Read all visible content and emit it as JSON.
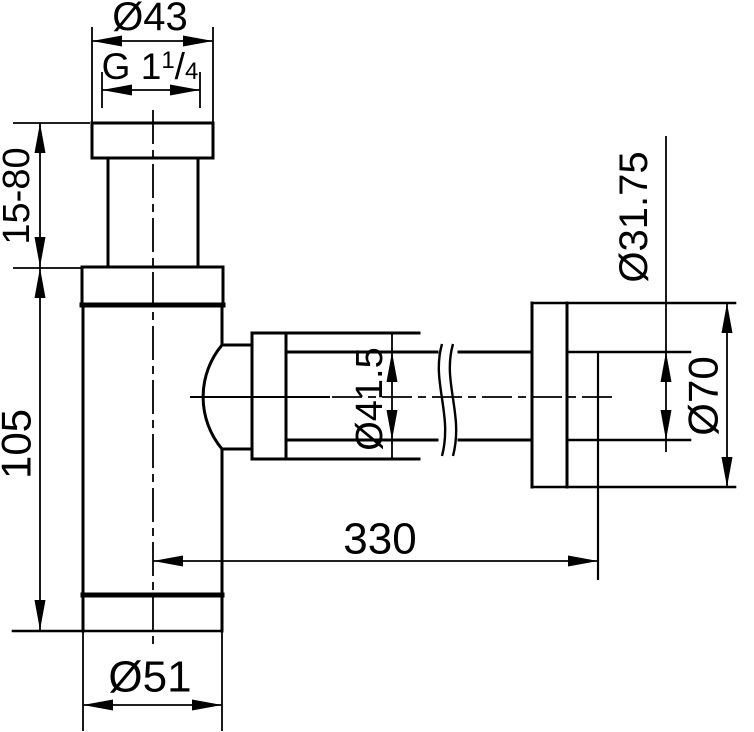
{
  "page": {
    "background": "#ffffff",
    "ink_color": "#000000"
  },
  "drawing": {
    "description": "bottle-trap siphon technical dimension drawing",
    "canvas": {
      "width": 754,
      "height": 732
    },
    "labels": [
      {
        "name": "dim-label-top-flange-diameter",
        "text": "Ø43",
        "x": 150,
        "y": 17,
        "rotate": 0,
        "size": 40
      },
      {
        "name": "dim-label-thread-size",
        "text": "G 1¼",
        "x": 150,
        "y": 66,
        "rotate": 0,
        "size": 37,
        "parts": [
          {
            "t": "G 1",
            "size": 37,
            "dy": 0
          },
          {
            "t": "1",
            "size": 24,
            "dy": -11
          },
          {
            "t": "/",
            "size": 37,
            "dy": 11
          },
          {
            "t": "4",
            "size": 24,
            "dy": 0
          }
        ]
      },
      {
        "name": "dim-label-adjustable-height",
        "text": "15-80",
        "x": 17,
        "y": 196,
        "rotate": -90,
        "size": 38
      },
      {
        "name": "dim-label-body-height",
        "text": "105",
        "x": 16,
        "y": 444,
        "rotate": -90,
        "size": 42
      },
      {
        "name": "dim-label-body-diameter",
        "text": "Ø51",
        "x": 150,
        "y": 677,
        "rotate": 0,
        "size": 44
      },
      {
        "name": "dim-label-sleeve-diameter",
        "text": "Ø41.5",
        "x": 370,
        "y": 399,
        "rotate": -90,
        "size": 38
      },
      {
        "name": "dim-label-wall-distance",
        "text": "330",
        "x": 380,
        "y": 539,
        "rotate": 0,
        "size": 44
      },
      {
        "name": "dim-label-wall-pipe-diameter",
        "text": "Ø31.75",
        "x": 634,
        "y": 217,
        "rotate": -90,
        "size": 40
      },
      {
        "name": "dim-label-wall-flange-diameter",
        "text": "Ø70",
        "x": 703,
        "y": 396,
        "rotate": -90,
        "size": 42
      }
    ],
    "lines": [
      {
        "name": "flange-top",
        "x1": 92,
        "y1": 123,
        "x2": 213,
        "y2": 123,
        "w": 3
      },
      {
        "name": "flange-bottom",
        "x1": 92,
        "y1": 158,
        "x2": 213,
        "y2": 158,
        "w": 3
      },
      {
        "name": "flange-left",
        "x1": 92,
        "y1": 123,
        "x2": 92,
        "y2": 158,
        "w": 3
      },
      {
        "name": "flange-right",
        "x1": 213,
        "y1": 123,
        "x2": 213,
        "y2": 158,
        "w": 3
      },
      {
        "name": "riser-tube-left",
        "x1": 108,
        "y1": 158,
        "x2": 108,
        "y2": 267,
        "w": 3
      },
      {
        "name": "riser-tube-right",
        "x1": 198,
        "y1": 158,
        "x2": 198,
        "y2": 267,
        "w": 3
      },
      {
        "name": "collar-top",
        "x1": 82,
        "y1": 267,
        "x2": 223,
        "y2": 267,
        "w": 3
      },
      {
        "name": "collar-left",
        "x1": 82,
        "y1": 267,
        "x2": 82,
        "y2": 304,
        "w": 3
      },
      {
        "name": "collar-right",
        "x1": 223,
        "y1": 267,
        "x2": 223,
        "y2": 304,
        "w": 3
      },
      {
        "name": "collar-body-joint",
        "x1": 82,
        "y1": 305,
        "x2": 223,
        "y2": 305,
        "w": 5
      },
      {
        "name": "body-left",
        "x1": 83,
        "y1": 305,
        "x2": 83,
        "y2": 631,
        "w": 3
      },
      {
        "name": "body-right-upper",
        "x1": 222,
        "y1": 305,
        "x2": 222,
        "y2": 345,
        "w": 3
      },
      {
        "name": "body-right-lower",
        "x1": 222,
        "y1": 449,
        "x2": 222,
        "y2": 595,
        "w": 3
      },
      {
        "name": "body-cap-joint",
        "x1": 83,
        "y1": 595,
        "x2": 222,
        "y2": 595,
        "w": 5
      },
      {
        "name": "cap-right",
        "x1": 222,
        "y1": 595,
        "x2": 222,
        "y2": 631,
        "w": 3
      },
      {
        "name": "cap-bottom-and-105-ext",
        "x1": 13,
        "y1": 631,
        "x2": 222,
        "y2": 631,
        "w": 2.6
      },
      {
        "name": "boss-stub-top",
        "x1": 222,
        "y1": 345,
        "x2": 252,
        "y2": 345,
        "w": 3
      },
      {
        "name": "boss-stub-bottom",
        "x1": 222,
        "y1": 449,
        "x2": 252,
        "y2": 449,
        "w": 3
      },
      {
        "name": "nut-left",
        "x1": 252,
        "y1": 333,
        "x2": 252,
        "y2": 459,
        "w": 3
      },
      {
        "name": "nut-right",
        "x1": 286,
        "y1": 333,
        "x2": 286,
        "y2": 459,
        "w": 3
      },
      {
        "name": "sleeve-top",
        "x1": 252,
        "y1": 333,
        "x2": 419,
        "y2": 333,
        "w": 3
      },
      {
        "name": "sleeve-bottom",
        "x1": 252,
        "y1": 459,
        "x2": 419,
        "y2": 459,
        "w": 3
      },
      {
        "name": "pipe-top-left",
        "x1": 286,
        "y1": 352,
        "x2": 437,
        "y2": 352,
        "w": 3
      },
      {
        "name": "pipe-bottom-left",
        "x1": 286,
        "y1": 440,
        "x2": 437,
        "y2": 440,
        "w": 3
      },
      {
        "name": "pipe-top-right",
        "x1": 459,
        "y1": 352,
        "x2": 532,
        "y2": 352,
        "w": 3
      },
      {
        "name": "pipe-bottom-right",
        "x1": 459,
        "y1": 440,
        "x2": 532,
        "y2": 440,
        "w": 3
      },
      {
        "name": "wall-flange-left",
        "x1": 532,
        "y1": 303,
        "x2": 532,
        "y2": 487,
        "w": 3
      },
      {
        "name": "wall-flange-right",
        "x1": 567,
        "y1": 303,
        "x2": 567,
        "y2": 487,
        "w": 3
      },
      {
        "name": "wall-flange-top-and-d70-ext",
        "x1": 532,
        "y1": 303,
        "x2": 735,
        "y2": 303,
        "w": 2.6
      },
      {
        "name": "wall-flange-bottom-and-d70-ext",
        "x1": 532,
        "y1": 487,
        "x2": 735,
        "y2": 487,
        "w": 2.6
      },
      {
        "name": "wall-pipe-top-and-ext",
        "x1": 567,
        "y1": 352,
        "x2": 690,
        "y2": 352,
        "w": 2.6
      },
      {
        "name": "wall-pipe-bottom-and-ext",
        "x1": 567,
        "y1": 440,
        "x2": 690,
        "y2": 440,
        "w": 2.6
      },
      {
        "name": "pipe-end-and-330-ext",
        "x1": 598,
        "y1": 352,
        "x2": 598,
        "y2": 580,
        "w": 2.2
      },
      {
        "name": "ext-d43-left",
        "x1": 92,
        "y1": 27,
        "x2": 92,
        "y2": 125,
        "w": 1.8
      },
      {
        "name": "ext-d43-right",
        "x1": 213,
        "y1": 27,
        "x2": 213,
        "y2": 125,
        "w": 1.8
      },
      {
        "name": "dim-d43",
        "x1": 92,
        "y1": 41,
        "x2": 213,
        "y2": 41,
        "w": 1.8
      },
      {
        "name": "ext-thread-left",
        "x1": 102,
        "y1": 72,
        "x2": 102,
        "y2": 108,
        "w": 1.8
      },
      {
        "name": "ext-thread-right",
        "x1": 200,
        "y1": 72,
        "x2": 200,
        "y2": 108,
        "w": 1.8
      },
      {
        "name": "dim-thread",
        "x1": 102,
        "y1": 90,
        "x2": 200,
        "y2": 90,
        "w": 1.8
      },
      {
        "name": "ext-1580-top",
        "x1": 13,
        "y1": 123,
        "x2": 90,
        "y2": 123,
        "w": 1.8
      },
      {
        "name": "ext-shared-collar-top",
        "x1": 13,
        "y1": 268,
        "x2": 81,
        "y2": 268,
        "w": 1.8
      },
      {
        "name": "dim-left-vertical",
        "x1": 40,
        "y1": 123,
        "x2": 40,
        "y2": 630,
        "w": 1.8
      },
      {
        "name": "ext-d51-left",
        "x1": 83,
        "y1": 631,
        "x2": 83,
        "y2": 731,
        "w": 1.8
      },
      {
        "name": "ext-d51-right",
        "x1": 222,
        "y1": 631,
        "x2": 222,
        "y2": 731,
        "w": 1.8
      },
      {
        "name": "dim-d51",
        "x1": 83,
        "y1": 705,
        "x2": 222,
        "y2": 705,
        "w": 1.8
      },
      {
        "name": "dim-330",
        "x1": 153,
        "y1": 561,
        "x2": 598,
        "y2": 561,
        "w": 1.8
      },
      {
        "name": "dim-d415",
        "x1": 392,
        "y1": 333,
        "x2": 392,
        "y2": 458,
        "w": 1.8
      },
      {
        "name": "dim-d3175",
        "x1": 666,
        "y1": 136,
        "x2": 666,
        "y2": 452,
        "w": 1.8
      },
      {
        "name": "dim-d70",
        "x1": 727,
        "y1": 303,
        "x2": 727,
        "y2": 487,
        "w": 1.8
      },
      {
        "name": "centerline-vertical",
        "x1": 153,
        "y1": 110,
        "x2": 153,
        "y2": 648,
        "w": 1.8,
        "dash": "34 6 8 6"
      },
      {
        "name": "centerline-horizontal-solid",
        "x1": 190,
        "y1": 397,
        "x2": 330,
        "y2": 397,
        "w": 2
      },
      {
        "name": "centerline-horizontal",
        "x1": 332,
        "y1": 397,
        "x2": 616,
        "y2": 397,
        "w": 1.8,
        "dash": "30 6 8 6"
      }
    ],
    "paths": [
      {
        "name": "boss-dome-arc",
        "d": "M 222 345 A 81 81 0 0 0 222 449",
        "w": 3
      },
      {
        "name": "pipe-break-squiggle-1",
        "d": "M 442 344 C 431 382 453 414 442 456",
        "w": 2.4
      },
      {
        "name": "pipe-break-squiggle-2",
        "d": "M 453 344 C 442 382 464 414 453 456",
        "w": 2.4
      }
    ],
    "arrows": [
      {
        "name": "arrow-d43-left",
        "x": 92,
        "y": 41,
        "dir": "left"
      },
      {
        "name": "arrow-d43-right",
        "x": 213,
        "y": 41,
        "dir": "right"
      },
      {
        "name": "arrow-thread-left",
        "x": 102,
        "y": 90,
        "dir": "left"
      },
      {
        "name": "arrow-thread-right",
        "x": 200,
        "y": 90,
        "dir": "right"
      },
      {
        "name": "arrow-1580-top",
        "x": 40,
        "y": 123,
        "dir": "up"
      },
      {
        "name": "arrow-1580-bottom",
        "x": 40,
        "y": 267,
        "dir": "down"
      },
      {
        "name": "arrow-105-top",
        "x": 40,
        "y": 268,
        "dir": "up"
      },
      {
        "name": "arrow-105-bottom",
        "x": 40,
        "y": 630,
        "dir": "down"
      },
      {
        "name": "arrow-d51-left",
        "x": 83,
        "y": 705,
        "dir": "left"
      },
      {
        "name": "arrow-d51-right",
        "x": 222,
        "y": 705,
        "dir": "right"
      },
      {
        "name": "arrow-330-left",
        "x": 153,
        "y": 561,
        "dir": "left"
      },
      {
        "name": "arrow-330-right",
        "x": 598,
        "y": 561,
        "dir": "right"
      },
      {
        "name": "arrow-d415-top",
        "x": 392,
        "y": 352,
        "dir": "up"
      },
      {
        "name": "arrow-d415-bottom",
        "x": 392,
        "y": 440,
        "dir": "down"
      },
      {
        "name": "arrow-d3175-top",
        "x": 666,
        "y": 352,
        "dir": "up"
      },
      {
        "name": "arrow-d3175-bottom",
        "x": 666,
        "y": 440,
        "dir": "down"
      },
      {
        "name": "arrow-d70-top",
        "x": 727,
        "y": 303,
        "dir": "up"
      },
      {
        "name": "arrow-d70-bottom",
        "x": 727,
        "y": 487,
        "dir": "down"
      }
    ],
    "arrow_geometry": {
      "length": 30,
      "half_width": 5.5
    }
  }
}
